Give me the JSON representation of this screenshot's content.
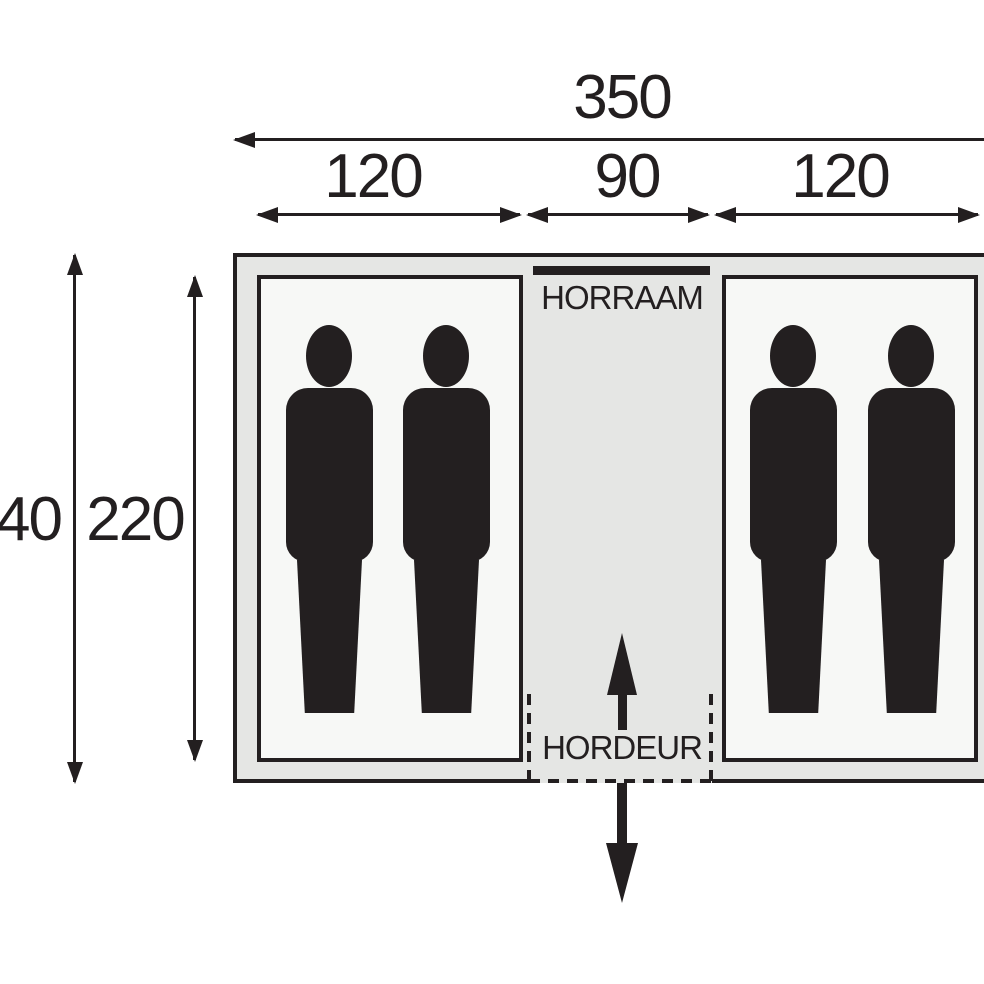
{
  "diagram": {
    "type": "tent-floor-plan",
    "top_dimensions": {
      "total": "350",
      "section_labels": [
        "120",
        "90",
        "120"
      ]
    },
    "side_dimensions": {
      "outer_depth": "40",
      "inner_depth": "220"
    },
    "annotations": {
      "window_label": "HORRAAM",
      "door_label": "HORDEUR"
    },
    "icons": {
      "person_silhouette_count": 4,
      "door_inward_arrow": "arrow-up",
      "door_outward_arrow": "arrow-down"
    },
    "colors": {
      "ink": "#231f20",
      "tent_fill": "#e5e6e4",
      "compartment_fill": "#f7f8f6",
      "bg": "#ffffff"
    }
  }
}
